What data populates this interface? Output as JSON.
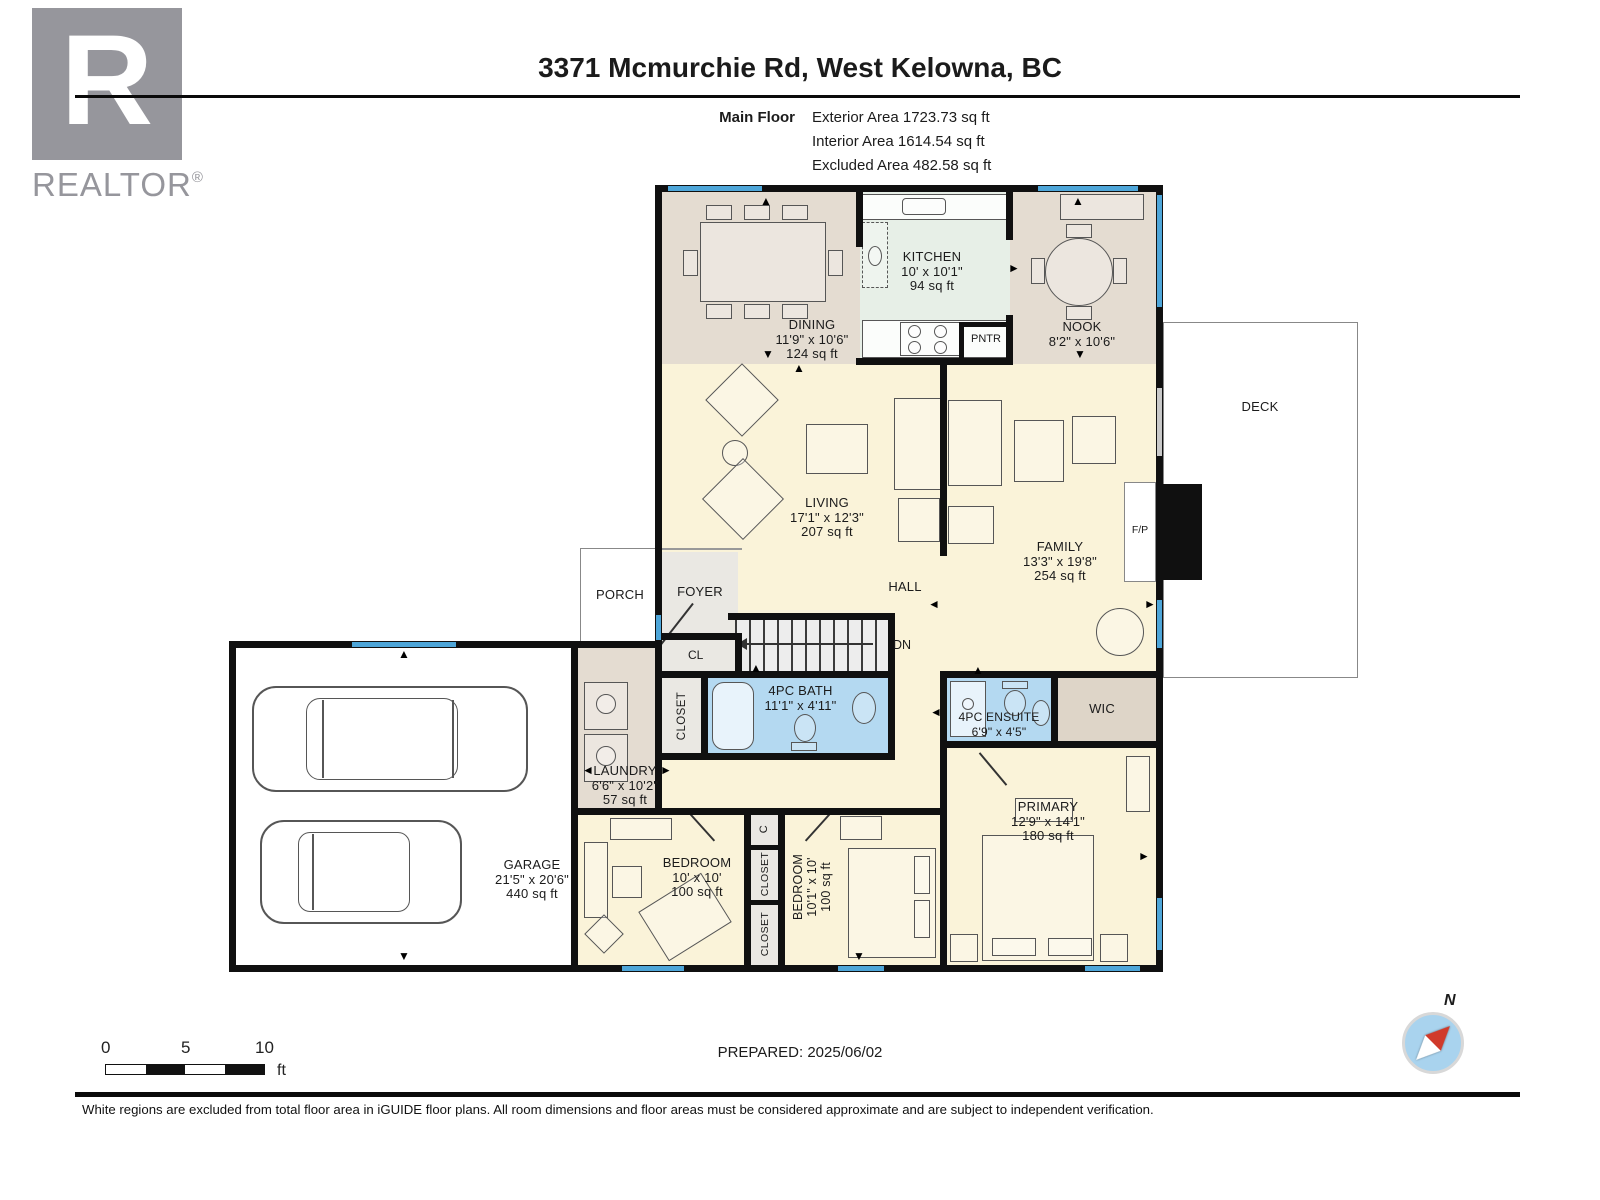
{
  "branding": {
    "logo_letter": "R",
    "logo_text": "REALTOR",
    "registered": "®"
  },
  "header": {
    "title": "3371 Mcmurchie Rd, West Kelowna, BC",
    "floor_label": "Main Floor",
    "stats": [
      "Exterior Area 1723.73 sq ft",
      "Interior Area 1614.54 sq ft",
      "Excluded Area 482.58 sq ft"
    ]
  },
  "rooms": {
    "dining": {
      "name": "DINING",
      "dims": "11'9\" x 10'6\"",
      "area": "124 sq ft"
    },
    "kitchen": {
      "name": "KITCHEN",
      "dims": "10' x 10'1\"",
      "area": "94 sq ft"
    },
    "nook": {
      "name": "NOOK",
      "dims": "8'2\" x 10'6\""
    },
    "living": {
      "name": "LIVING",
      "dims": "17'1\" x 12'3\"",
      "area": "207 sq ft"
    },
    "family": {
      "name": "FAMILY",
      "dims": "13'3\" x 19'8\"",
      "area": "254 sq ft"
    },
    "deck": {
      "name": "DECK"
    },
    "porch": {
      "name": "PORCH"
    },
    "foyer": {
      "name": "FOYER"
    },
    "hall": {
      "name": "HALL"
    },
    "bath": {
      "name": "4PC BATH",
      "dims": "11'1\" x 4'11\""
    },
    "ensuite": {
      "name": "4PC ENSUITE",
      "dims": "6'9\" x 4'5\""
    },
    "wic": {
      "name": "WIC"
    },
    "laundry": {
      "name": "LAUNDRY",
      "dims": "6'6\" x 10'2\"",
      "area": "57 sq ft"
    },
    "garage": {
      "name": "GARAGE",
      "dims": "21'5\" x 20'6\"",
      "area": "440 sq ft"
    },
    "bedroom1": {
      "name": "BEDROOM",
      "dims": "10' x 10'",
      "area": "100 sq ft"
    },
    "bedroom2": {
      "name": "BEDROOM",
      "dims": "10'1\" x 10'",
      "area": "100 sq ft"
    },
    "primary": {
      "name": "PRIMARY",
      "dims": "12'9\" x 14'1\"",
      "area": "180 sq ft"
    }
  },
  "small_labels": {
    "pantry": "PNTR",
    "fireplace": "F/P",
    "hall_closet": "CL",
    "stairs_down": "DN",
    "small_closet": "C",
    "closet": "CLOSET"
  },
  "scale_bar": {
    "ticks": [
      "0",
      "5",
      "10"
    ],
    "unit": "ft"
  },
  "prepared_label": "PREPARED: 2025/06/02",
  "compass": {
    "north_label": "N"
  },
  "footer": {
    "disclaimer": "White regions are excluded from total floor area in iGUIDE floor plans. All room dimensions and floor areas must be considered approximate and are subject to independent verification."
  },
  "colors": {
    "wall": "#101010",
    "floor_cream": "#faf3d9",
    "floor_tan": "#e4dcd1",
    "floor_kitchen": "#e7efe7",
    "bath_blue": "#b4d9f1",
    "window_blue": "#4ea6d9",
    "closet_gray": "#eae8e3",
    "wic_tan": "#ded5c8",
    "compass_red": "#d03a2b",
    "compass_blue": "#a9d3ee",
    "logo_gray": "#96969c"
  }
}
